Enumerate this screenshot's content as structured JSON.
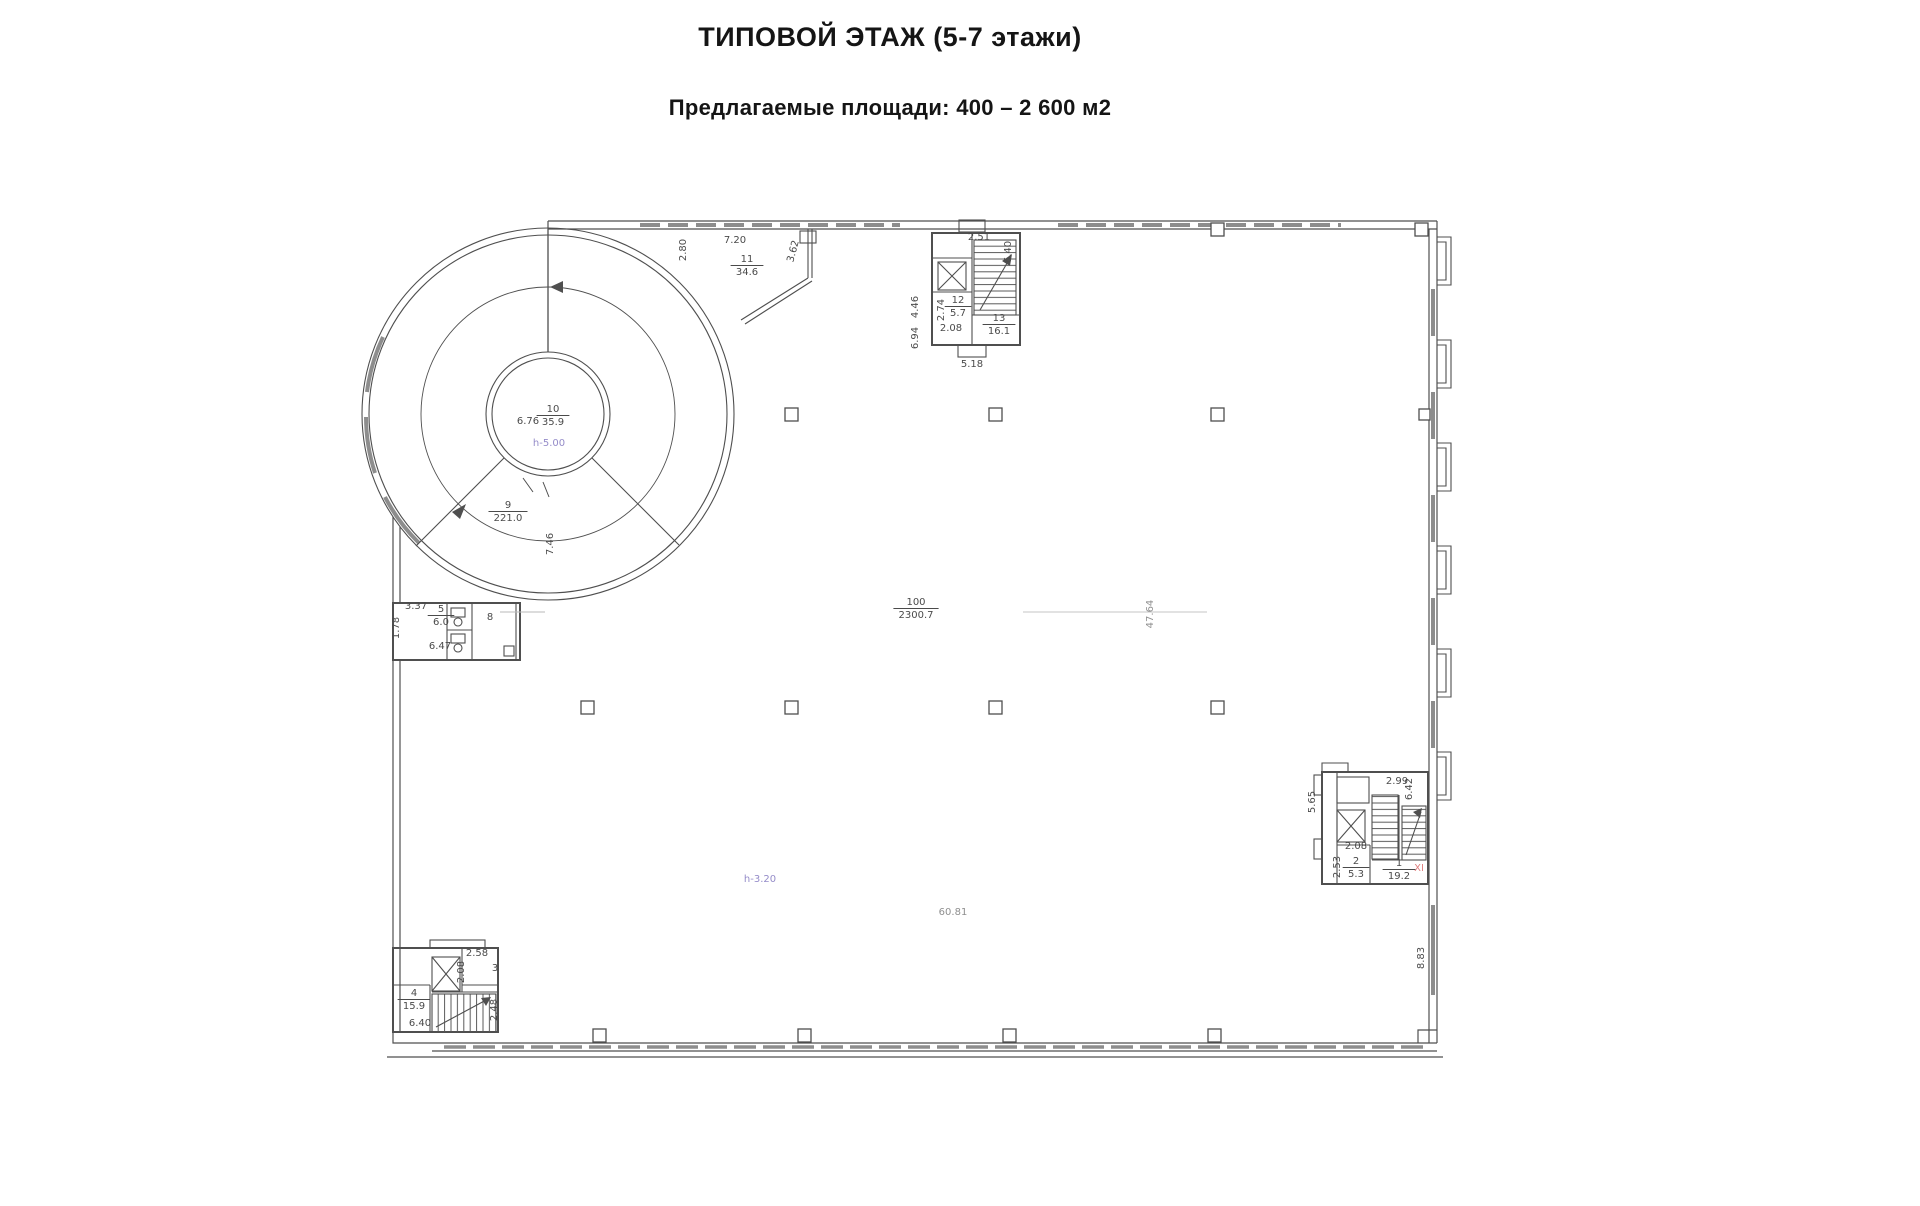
{
  "header": {
    "title": "ТИПОВОЙ ЭТАЖ (5-7 этажи)",
    "subtitle": "Предлагаемые площади: 400 – 2 600 м2"
  },
  "colors": {
    "line": "#4f4f4f",
    "dim_label": "#4a4a4a",
    "height_label": "#958cc9",
    "faint_label": "#8f8f8f",
    "accent_red": "#e08080",
    "glazing": "#8d8d8d"
  },
  "plan": {
    "dimension_labels": [
      {
        "text": "7.20",
        "x": 735,
        "y": 243,
        "r": 0,
        "c": "dim"
      },
      {
        "text": "2.80",
        "x": 686,
        "y": 250,
        "r": -90,
        "c": "dim"
      },
      {
        "text": "3.62",
        "x": 796,
        "y": 252,
        "r": -75,
        "c": "dim"
      },
      {
        "text": "2.51",
        "x": 979,
        "y": 240,
        "r": 0,
        "c": "dim"
      },
      {
        "text": "6.40",
        "x": 1011,
        "y": 252,
        "r": -90,
        "c": "dim"
      },
      {
        "text": "4.46",
        "x": 918,
        "y": 307,
        "r": -90,
        "c": "dim"
      },
      {
        "text": "6.94",
        "x": 918,
        "y": 338,
        "r": -90,
        "c": "dim"
      },
      {
        "text": "2.74",
        "x": 944,
        "y": 310,
        "r": -90,
        "c": "dim"
      },
      {
        "text": "2.08",
        "x": 951,
        "y": 331,
        "r": 0,
        "c": "dim"
      },
      {
        "text": "5.18",
        "x": 972,
        "y": 367,
        "r": 0,
        "c": "dim"
      },
      {
        "text": "6.76",
        "x": 528,
        "y": 424,
        "r": 0,
        "c": "dim"
      },
      {
        "text": "h-5.00",
        "x": 549,
        "y": 446,
        "r": 0,
        "c": "height"
      },
      {
        "text": "7.46",
        "x": 553,
        "y": 544,
        "r": -90,
        "c": "dim"
      },
      {
        "text": "3.37",
        "x": 416,
        "y": 609,
        "r": 0,
        "c": "dim"
      },
      {
        "text": "1.78",
        "x": 399,
        "y": 628,
        "r": -90,
        "c": "dim"
      },
      {
        "text": "8",
        "x": 490,
        "y": 620,
        "r": 0,
        "c": "dim"
      },
      {
        "text": "6.47",
        "x": 440,
        "y": 649,
        "r": 0,
        "c": "dim"
      },
      {
        "text": "47.64",
        "x": 1153,
        "y": 614,
        "r": -90,
        "c": "faint"
      },
      {
        "text": "h-3.20",
        "x": 760,
        "y": 882,
        "r": 0,
        "c": "height"
      },
      {
        "text": "60.81",
        "x": 953,
        "y": 915,
        "r": 0,
        "c": "faint"
      },
      {
        "text": "2.58",
        "x": 477,
        "y": 956,
        "r": 0,
        "c": "dim"
      },
      {
        "text": "2.08",
        "x": 464,
        "y": 972,
        "r": -90,
        "c": "dim"
      },
      {
        "text": "3",
        "x": 495,
        "y": 971,
        "r": 0,
        "c": "dim"
      },
      {
        "text": "6.40",
        "x": 420,
        "y": 1026,
        "r": 0,
        "c": "dim"
      },
      {
        "text": "2.48",
        "x": 497,
        "y": 1010,
        "r": -90,
        "c": "dim"
      },
      {
        "text": "5.65",
        "x": 1315,
        "y": 802,
        "r": -90,
        "c": "dim"
      },
      {
        "text": "2.99",
        "x": 1397,
        "y": 784,
        "r": 0,
        "c": "dim"
      },
      {
        "text": "6.42",
        "x": 1412,
        "y": 789,
        "r": -90,
        "c": "dim"
      },
      {
        "text": "2.08",
        "x": 1356,
        "y": 849,
        "r": 0,
        "c": "dim"
      },
      {
        "text": "2.53",
        "x": 1340,
        "y": 867,
        "r": -90,
        "c": "dim"
      },
      {
        "text": "XI",
        "x": 1419,
        "y": 871,
        "r": 0,
        "c": "red"
      },
      {
        "text": "8.83",
        "x": 1424,
        "y": 958,
        "r": -90,
        "c": "dim"
      }
    ],
    "room_labels": [
      {
        "num": "10",
        "den": "35.9",
        "x": 553,
        "y": 412
      },
      {
        "num": "9",
        "den": "221.0",
        "x": 508,
        "y": 508
      },
      {
        "num": "11",
        "den": "34.6",
        "x": 747,
        "y": 262
      },
      {
        "num": "12",
        "den": "5.7",
        "x": 958,
        "y": 303
      },
      {
        "num": "13",
        "den": "16.1",
        "x": 999,
        "y": 321
      },
      {
        "num": "100",
        "den": "2300.7",
        "x": 916,
        "y": 605
      },
      {
        "num": "5",
        "den": "6.0",
        "x": 441,
        "y": 612
      },
      {
        "num": "4",
        "den": "15.9",
        "x": 414,
        "y": 996
      },
      {
        "num": "2",
        "den": "5.3",
        "x": 1356,
        "y": 864
      },
      {
        "num": "1",
        "den": "19.2",
        "x": 1399,
        "y": 866
      }
    ]
  }
}
